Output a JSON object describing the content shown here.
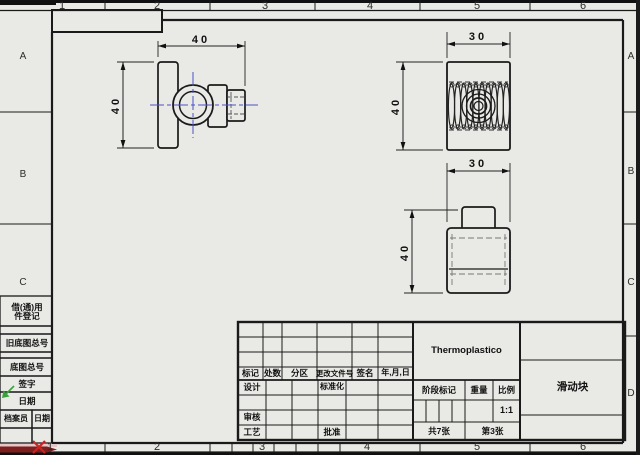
{
  "colors": {
    "paper": "#e9e9e6",
    "line": "#1a1a1a",
    "centerline_blue": "#4c52c8",
    "origin_red": "#cc2222",
    "axis_bar_maroon": "#7d1f1f",
    "view_origin_green": "#3aa23a"
  },
  "zones": {
    "top": [
      "1",
      "2",
      "3",
      "4",
      "5",
      "6"
    ],
    "bottom": [
      "1",
      "2",
      "3",
      "4",
      "5",
      "6"
    ],
    "left": [
      "A",
      "B",
      "C"
    ],
    "right": [
      "A",
      "B",
      "C",
      "D"
    ]
  },
  "dimensions": {
    "top_view_width": "40",
    "top_view_height": "40",
    "section_view_width": "30",
    "section_view_height": "40",
    "front_view_width": "30",
    "front_view_height": "40"
  },
  "margin_blocks": {
    "borrowed_line1": "借(通)用",
    "borrowed_line2": "件登记",
    "old_base_no": "旧底图总号",
    "base_no": "底图总号",
    "sign": "签字",
    "date": "日期",
    "archivist": "档案员",
    "archive_date": "日期"
  },
  "title_block": {
    "mark": "标记",
    "qty": "处数",
    "zone": "分区",
    "change_doc": "更改文件号",
    "sign": "签名",
    "date": "年,月,日",
    "design": "设计",
    "standardize": "标准化",
    "review": "审核",
    "process": "工艺",
    "approve": "批准",
    "material": "Thermoplastico",
    "stage_mark": "阶段标记",
    "weight": "重量",
    "scale": "比例",
    "scale_value": "1:1",
    "sheets_total": "共7张",
    "sheet_num": "第3张",
    "part_name": "滑动块"
  }
}
